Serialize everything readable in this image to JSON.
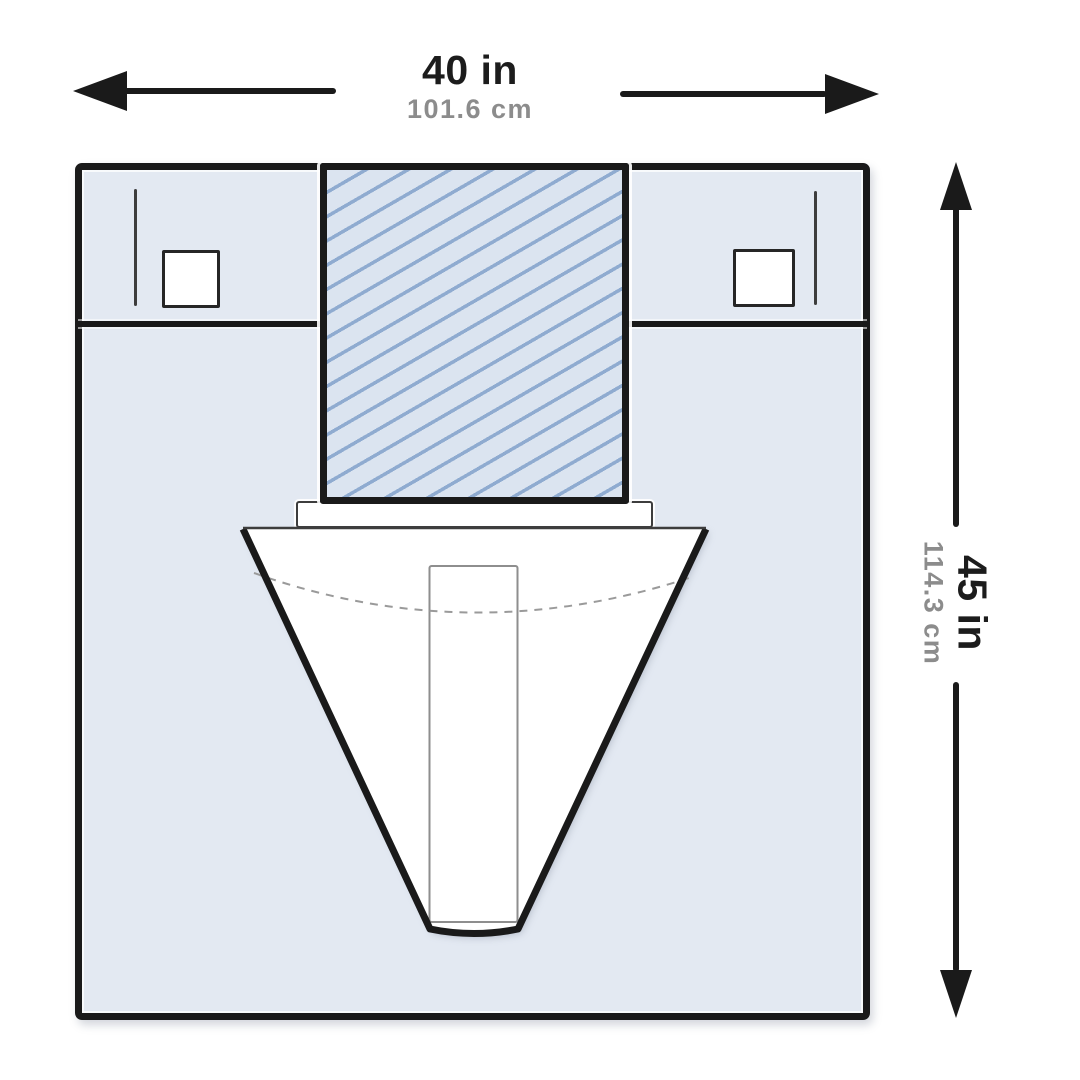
{
  "labels": {
    "width": {
      "inches": "40 in",
      "centimeters": "101.6 cm"
    },
    "height": {
      "inches": "45 in",
      "centimeters": "114.3 cm"
    }
  },
  "icons": {
    "width-arrow-left-icon": "triangle-left",
    "width-arrow-right-icon": "triangle-right",
    "height-arrow-up-icon": "triangle-up",
    "height-arrow-down-icon": "triangle-down"
  },
  "colors": {
    "background": "#ffffff",
    "outline": "#1a1a1a",
    "drape-fill": "#e3e9f2",
    "fenestration-fill": "#dbe4f0",
    "hatch-line": "#8fabd0",
    "pouch-fill": "#ffffff",
    "label-primary": "#1c1c1c",
    "label-secondary": "#8c8c8c",
    "thin-line": "#3d3d3d",
    "sleeve-line": "#8e8e8e"
  }
}
